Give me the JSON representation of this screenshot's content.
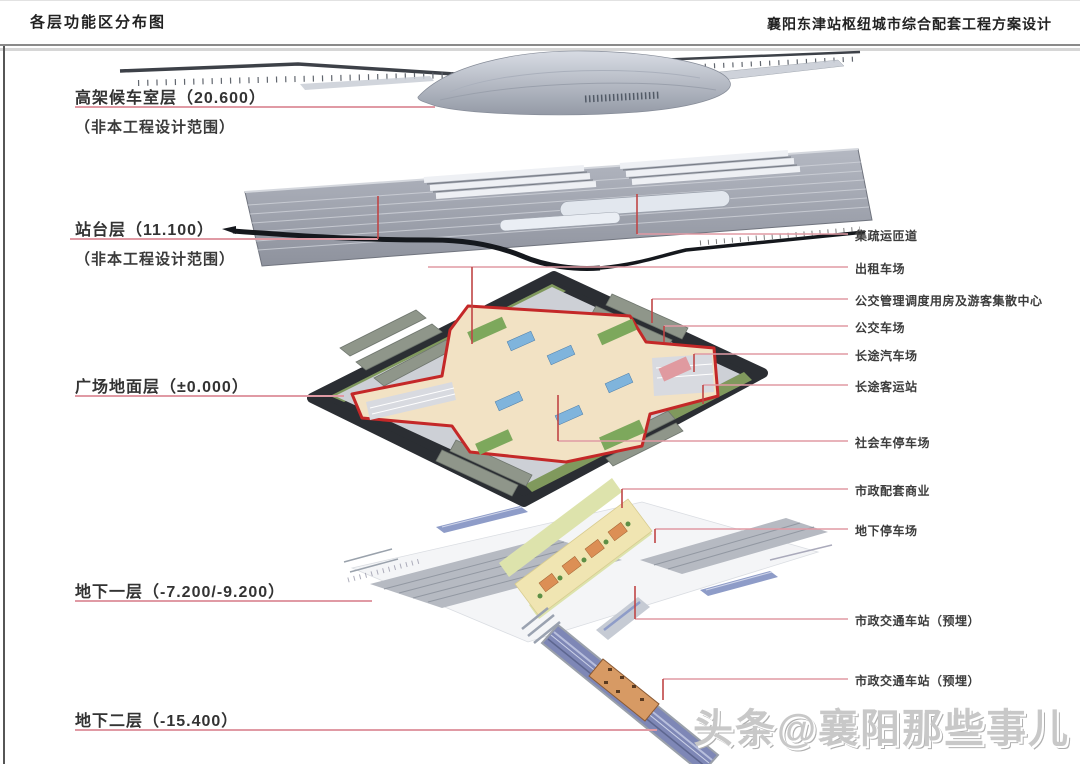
{
  "header": {
    "left_title": "各层功能区分布图",
    "right_title": "襄阳东津站枢纽城市综合配套工程方案设计"
  },
  "layers": [
    {
      "id": "elevated-waiting-hall",
      "label": "高架候车室层（20.600）",
      "note": "（非本工程设计范围）",
      "elevation": "20.600"
    },
    {
      "id": "platform-level",
      "label": "站台层（11.100）",
      "note": "（非本工程设计范围）",
      "elevation": "11.100"
    },
    {
      "id": "plaza-ground-level",
      "label": "广场地面层（±0.000）",
      "note": "",
      "elevation": "±0.000"
    },
    {
      "id": "basement-1",
      "label": "地下一层（-7.200/-9.200）",
      "note": "",
      "elevation": "-7.200/-9.200"
    },
    {
      "id": "basement-2",
      "label": "地下二层（-15.400）",
      "note": "",
      "elevation": "-15.400"
    }
  ],
  "callouts": [
    "集疏运匝道",
    "出租车场",
    "公交管理调度用房及游客集散中心",
    "公交车场",
    "长途汽车场",
    "长途客运站",
    "社会车停车场",
    "市政配套商业",
    "地下停车场",
    "市政交通车站（预埋）",
    "市政交通车站（预埋）"
  ],
  "watermark": "头条@襄阳那些事儿",
  "colors": {
    "leader_pink": "#e09aa4",
    "leader_red": "#c04545",
    "plaza_outline_red": "#c42828",
    "plaza_base_dark": "#2b2e33",
    "slab_gray": "#a7abb5",
    "rail_blue": "#7e87b6",
    "station_orange": "#d79a64"
  }
}
